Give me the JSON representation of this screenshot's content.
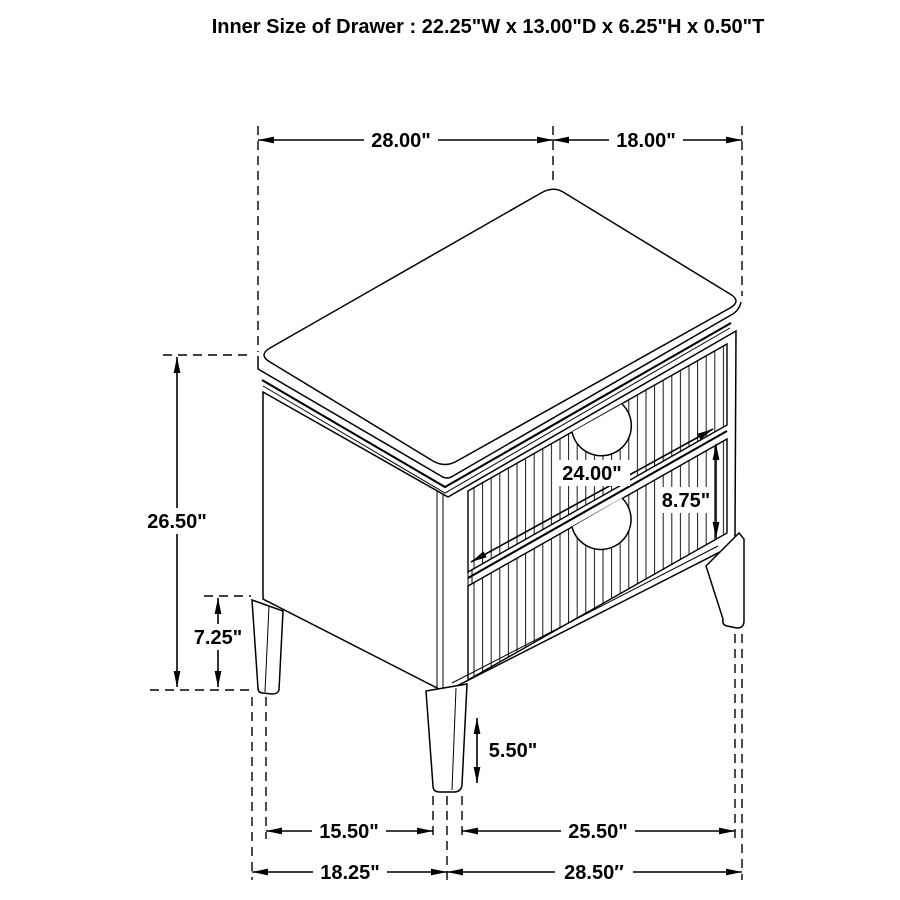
{
  "title": "Inner Size of Drawer : 22.25\"W x 13.00\"D x 6.25\"H x 0.50\"T",
  "colors": {
    "line": "#000000",
    "background": "#ffffff"
  },
  "dims": {
    "top_width": "28.00\"",
    "top_depth": "18.00\"",
    "overall_height": "26.50\"",
    "leg_section_height": "7.25\"",
    "drawer_front_width": "24.00\"",
    "drawer_front_height": "8.75\"",
    "leg_height": "5.50\"",
    "leg_span_front": "15.50\"",
    "leg_span_side": "25.50\"",
    "base_width_front": "18.25\"",
    "base_width_side": "28.50″"
  }
}
